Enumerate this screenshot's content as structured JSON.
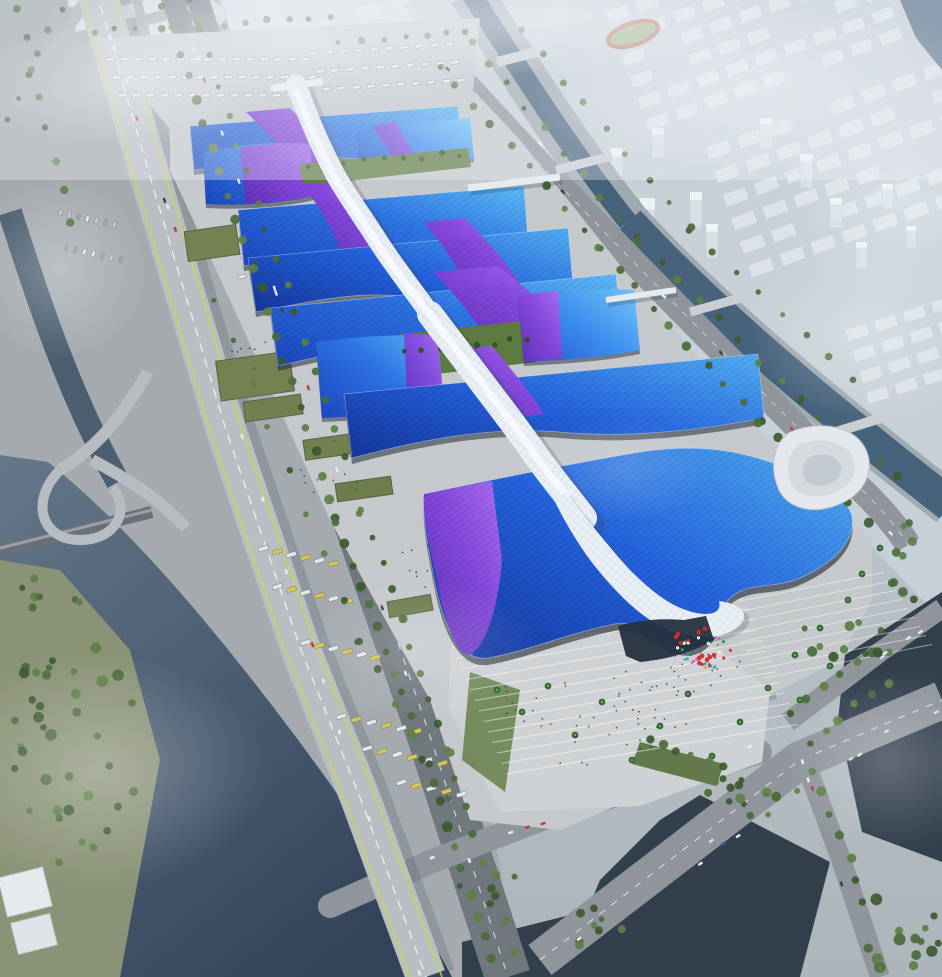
{
  "meta": {
    "title": "Aerial rendering of a riverside exhibition and convention center",
    "description": "Bird's-eye architectural rendering: rows of wavy blue exhibition-hall roofs with purple ribbon graphics, crossed by a white serpentine central concourse, surrounded by boulevards, canals, ponds, parking aprons and a foggy city skyline."
  },
  "palette": {
    "bgTop": "#d6dfe5",
    "bgBottom": "#adb5bb",
    "westLand": "#a4aaae",
    "eastLand": "#c7d0d6",
    "cityBlock": "#e0e6ea",
    "cityStroke": "#c4cdd3",
    "towerBody": "#d9e0e6",
    "towerTop": "#eef2f6",
    "waterCanal": "#47637c",
    "waterWest": "#4c5f70",
    "waterSWTop": "#64788a",
    "waterSWBot": "#33445a",
    "pond": "#323f4d",
    "bank": "#9fa9b0",
    "roadHwy": "#b9bec3",
    "roadMain": "#70777d",
    "roadMid": "#8f959b",
    "laneWhite": "#eef1f3",
    "laneYellow": "#c9d64f",
    "apron": "#c5c9cb",
    "plaza": "#cfd2d4",
    "garden": "#5d7a40",
    "grassDark": "#55703c",
    "treeDark": "#3c5a30",
    "tree": "#4a6b3a",
    "treeLight": "#5c7f46",
    "palm": "#2f6b38",
    "roofDeep": "#1c49c0",
    "roofBlue": "#2e74e4",
    "roofLight": "#4fa8f0",
    "purpleDeep": "#5f2fb4",
    "purple": "#8448dc",
    "purpleLight": "#a86ef0",
    "spine": "#e9eff5",
    "spineShadow": "#36444f",
    "glass": "#253140",
    "sideDark": "#232d39",
    "swirl": "#e4e8ec",
    "lantern": "#d82828",
    "trackRed": "#b85040",
    "infield": "#8aa060"
  },
  "scene": {
    "seed": 7,
    "city_grids": [
      {
        "x": 598,
        "y": -10,
        "rot": -20,
        "cols": 9,
        "rows": 7,
        "w": 22,
        "h": 12,
        "dx": 31,
        "dy": 23,
        "op": 0.9
      },
      {
        "x": 705,
        "y": 148,
        "rot": -20,
        "cols": 8,
        "rows": 6,
        "w": 24,
        "h": 13,
        "dx": 33,
        "dy": 25,
        "op": 0.85
      },
      {
        "x": 845,
        "y": 330,
        "rot": -18,
        "cols": 4,
        "rows": 4,
        "w": 22,
        "h": 12,
        "dx": 30,
        "dy": 22,
        "op": 0.8
      },
      {
        "x": 66,
        "y": -6,
        "rot": -14,
        "cols": 6,
        "rows": 3,
        "w": 26,
        "h": 14,
        "dx": 36,
        "dy": 25,
        "op": 0.85
      },
      {
        "x": 348,
        "y": -12,
        "rot": -18,
        "cols": 5,
        "rows": 2,
        "w": 24,
        "h": 12,
        "dx": 32,
        "dy": 22,
        "op": 0.8
      }
    ],
    "towers": [
      [
        530,
        178,
        12,
        36
      ],
      [
        560,
        208,
        16,
        55
      ],
      [
        585,
        233,
        14,
        46
      ],
      [
        610,
        188,
        13,
        40
      ],
      [
        640,
        248,
        15,
        50
      ],
      [
        652,
        158,
        12,
        30
      ],
      [
        662,
        283,
        13,
        38
      ],
      [
        690,
        228,
        12,
        36
      ],
      [
        706,
        258,
        12,
        34
      ],
      [
        760,
        148,
        12,
        30
      ],
      [
        800,
        188,
        13,
        34
      ],
      [
        830,
        228,
        12,
        30
      ],
      [
        856,
        268,
        11,
        26
      ],
      [
        882,
        208,
        11,
        24
      ],
      [
        906,
        248,
        10,
        22
      ]
    ],
    "tree_lines": [
      {
        "x1": 162,
        "y1": 6,
        "x2": 252,
        "y2": 266,
        "n": 12,
        "r": 4
      },
      {
        "x1": 252,
        "y1": 266,
        "x2": 338,
        "y2": 520,
        "n": 12,
        "r": 4
      },
      {
        "x1": 338,
        "y1": 520,
        "x2": 424,
        "y2": 758,
        "n": 12,
        "r": 4.4
      },
      {
        "x1": 424,
        "y1": 758,
        "x2": 492,
        "y2": 960,
        "n": 10,
        "r": 4.6
      },
      {
        "x1": 188,
        "y1": 0,
        "x2": 276,
        "y2": 258,
        "n": 10,
        "r": 3.2
      },
      {
        "x1": 276,
        "y1": 258,
        "x2": 362,
        "y2": 512,
        "n": 10,
        "r": 3.4
      },
      {
        "x1": 362,
        "y1": 512,
        "x2": 448,
        "y2": 752,
        "n": 10,
        "r": 3.6
      },
      {
        "x1": 448,
        "y1": 752,
        "x2": 512,
        "y2": 950,
        "n": 8,
        "r": 3.8
      },
      {
        "x1": 18,
        "y1": 10,
        "x2": 70,
        "y2": 220,
        "n": 8,
        "r": 3.4
      },
      {
        "x1": 60,
        "y1": 8,
        "x2": 6,
        "y2": 118,
        "n": 6,
        "r": 3
      },
      {
        "x1": 438,
        "y1": 64,
        "x2": 600,
        "y2": 250,
        "n": 10,
        "r": 3.6
      },
      {
        "x1": 600,
        "y1": 250,
        "x2": 760,
        "y2": 420,
        "n": 10,
        "r": 3.8
      },
      {
        "x1": 760,
        "y1": 420,
        "x2": 868,
        "y2": 520,
        "n": 7,
        "r": 4
      },
      {
        "x1": 470,
        "y1": 40,
        "x2": 640,
        "y2": 240,
        "n": 10,
        "r": 3.2
      },
      {
        "x1": 640,
        "y1": 240,
        "x2": 800,
        "y2": 400,
        "n": 9,
        "r": 3.4
      },
      {
        "x1": 800,
        "y1": 400,
        "x2": 898,
        "y2": 478,
        "n": 6,
        "r": 3.6
      },
      {
        "x1": 520,
        "y1": 30,
        "x2": 690,
        "y2": 230,
        "n": 9,
        "r": 3
      },
      {
        "x1": 690,
        "y1": 230,
        "x2": 850,
        "y2": 380,
        "n": 8,
        "r": 3.2
      },
      {
        "x1": 95,
        "y1": 32,
        "x2": 330,
        "y2": 18,
        "n": 12,
        "r": 3
      },
      {
        "x1": 340,
        "y1": 42,
        "x2": 468,
        "y2": 32,
        "n": 7,
        "r": 3
      },
      {
        "x1": 215,
        "y1": 300,
        "x2": 360,
        "y2": 640,
        "n": 9,
        "r": 3.2
      },
      {
        "x1": 360,
        "y1": 640,
        "x2": 448,
        "y2": 796,
        "n": 6,
        "r": 3.4
      },
      {
        "x1": 792,
        "y1": 712,
        "x2": 872,
        "y2": 652,
        "n": 6,
        "r": 4
      },
      {
        "x1": 808,
        "y1": 742,
        "x2": 888,
        "y2": 682,
        "n": 6,
        "r": 4
      },
      {
        "x1": 812,
        "y1": 772,
        "x2": 858,
        "y2": 880,
        "n": 6,
        "r": 4.2
      },
      {
        "x1": 648,
        "y1": 742,
        "x2": 722,
        "y2": 768,
        "n": 6,
        "r": 3.8
      }
    ],
    "tree_clusters": [
      {
        "cx": 75,
        "cy": 760,
        "rx": 70,
        "ry": 120,
        "n": 32,
        "r": 4.6
      },
      {
        "cx": 40,
        "cy": 620,
        "rx": 45,
        "ry": 60,
        "n": 12,
        "r": 4.2
      },
      {
        "cx": 850,
        "cy": 640,
        "rx": 55,
        "ry": 26,
        "n": 12,
        "r": 4
      },
      {
        "cx": 740,
        "cy": 800,
        "rx": 70,
        "ry": 22,
        "n": 14,
        "r": 4
      },
      {
        "cx": 900,
        "cy": 930,
        "rx": 50,
        "ry": 50,
        "n": 16,
        "r": 4.6
      },
      {
        "cx": 600,
        "cy": 930,
        "rx": 40,
        "ry": 28,
        "n": 8,
        "r": 4
      },
      {
        "cx": 488,
        "cy": 884,
        "rx": 30,
        "ry": 24,
        "n": 6,
        "r": 3.8
      },
      {
        "cx": 912,
        "cy": 560,
        "rx": 26,
        "ry": 46,
        "n": 9,
        "r": 3.8
      }
    ],
    "garden_trees": [
      {
        "x1": 306,
        "y1": 168,
        "x2": 462,
        "y2": 153,
        "n": 9,
        "r": 2.6
      },
      {
        "x1": 404,
        "y1": 352,
        "x2": 528,
        "y2": 338,
        "n": 8,
        "r": 2.9
      }
    ],
    "palms": [
      [
        497,
        690
      ],
      [
        522,
        712
      ],
      [
        548,
        686
      ],
      [
        575,
        735
      ],
      [
        602,
        702
      ],
      [
        632,
        760
      ],
      [
        660,
        726
      ],
      [
        688,
        694
      ],
      [
        712,
        756
      ],
      [
        740,
        722
      ],
      [
        768,
        688
      ],
      [
        795,
        655
      ],
      [
        820,
        628
      ],
      [
        848,
        600
      ],
      [
        800,
        700
      ],
      [
        830,
        666
      ],
      [
        862,
        574
      ],
      [
        880,
        548
      ]
    ],
    "vehicle_rows": [
      {
        "x": 106,
        "y": 58,
        "n": 15,
        "dx": 14,
        "dy": 0,
        "len": 8,
        "w": 3.5,
        "rot": -8,
        "kind": "truck"
      },
      {
        "x": 112,
        "y": 76,
        "n": 15,
        "dx": 14,
        "dy": 0,
        "len": 8,
        "w": 3.5,
        "rot": -8,
        "kind": "truck"
      },
      {
        "x": 118,
        "y": 94,
        "n": 14,
        "dx": 14,
        "dy": 0,
        "len": 8,
        "w": 3.5,
        "rot": -8,
        "kind": "truck"
      },
      {
        "x": 310,
        "y": 52,
        "n": 10,
        "dx": 15,
        "dy": -1,
        "len": 8,
        "w": 3.5,
        "rot": -8,
        "kind": "truck"
      },
      {
        "x": 316,
        "y": 70,
        "n": 10,
        "dx": 15,
        "dy": -1,
        "len": 8,
        "w": 3.5,
        "rot": -8,
        "kind": "truck"
      },
      {
        "x": 322,
        "y": 88,
        "n": 10,
        "dx": 15,
        "dy": -1,
        "len": 8,
        "w": 3.5,
        "rot": -8,
        "kind": "truck"
      },
      {
        "x": 58,
        "y": 215,
        "n": 7,
        "dx": 9,
        "dy": 2,
        "len": 6,
        "w": 3,
        "rot": -70,
        "kind": "car"
      },
      {
        "x": 64,
        "y": 250,
        "n": 7,
        "dx": 9,
        "dy": 2,
        "len": 6,
        "w": 3,
        "rot": -70,
        "kind": "car"
      },
      {
        "x": 228,
        "y": 252,
        "n": 6,
        "dx": 12,
        "dy": 3,
        "len": 8,
        "w": 3.2,
        "rot": -14,
        "kind": "truck"
      },
      {
        "x": 238,
        "y": 276,
        "n": 6,
        "dx": 12,
        "dy": 3,
        "len": 8,
        "w": 3.2,
        "rot": -14,
        "kind": "truck"
      },
      {
        "x": 258,
        "y": 548,
        "n": 6,
        "dx": 14,
        "dy": 3,
        "len": 10,
        "w": 4,
        "rot": -16,
        "kind": "bus"
      },
      {
        "x": 272,
        "y": 586,
        "n": 6,
        "dx": 14,
        "dy": 3,
        "len": 10,
        "w": 4,
        "rot": -16,
        "kind": "bus"
      },
      {
        "x": 300,
        "y": 642,
        "n": 6,
        "dx": 14,
        "dy": 3,
        "len": 10,
        "w": 4,
        "rot": -16,
        "kind": "bus"
      },
      {
        "x": 336,
        "y": 716,
        "n": 6,
        "dx": 15,
        "dy": 3,
        "len": 10,
        "w": 4,
        "rot": -18,
        "kind": "bus"
      },
      {
        "x": 362,
        "y": 748,
        "n": 6,
        "dx": 15,
        "dy": 3,
        "len": 10,
        "w": 4,
        "rot": -18,
        "kind": "bus"
      },
      {
        "x": 396,
        "y": 782,
        "n": 5,
        "dx": 15,
        "dy": 3,
        "len": 10,
        "w": 4,
        "rot": -18,
        "kind": "bus"
      }
    ],
    "car_lanes": [
      {
        "x1": 100,
        "y1": 0,
        "x2": 420,
        "y2": 970,
        "n": 16
      },
      {
        "x1": 182,
        "y1": 10,
        "x2": 505,
        "y2": 965,
        "n": 14
      },
      {
        "x1": 445,
        "y1": 70,
        "x2": 900,
        "y2": 540,
        "n": 10
      },
      {
        "x1": 540,
        "y1": 955,
        "x2": 935,
        "y2": 705,
        "n": 9
      },
      {
        "x1": 760,
        "y1": 752,
        "x2": 430,
        "y2": 862,
        "n": 5
      },
      {
        "x1": 800,
        "y1": 748,
        "x2": 868,
        "y2": 960,
        "n": 4
      },
      {
        "x1": 788,
        "y1": 722,
        "x2": 935,
        "y2": 612,
        "n": 4
      }
    ],
    "step_fans": [
      {
        "x": 452,
        "y": 648,
        "n": 13,
        "dx": 4.5,
        "dy": 10.5,
        "len": 292,
        "slope": -0.17,
        "op": 0.5
      },
      {
        "x": 716,
        "y": 606,
        "n": 9,
        "dx": 6,
        "dy": 9,
        "len": 168,
        "slope": -0.2,
        "op": 0.45
      }
    ],
    "people_clusters": [
      {
        "cx": 660,
        "cy": 690,
        "rx": 60,
        "ry": 40,
        "n": 30
      },
      {
        "cx": 700,
        "cy": 660,
        "rx": 40,
        "ry": 20,
        "n": 20
      },
      {
        "cx": 600,
        "cy": 740,
        "rx": 70,
        "ry": 30,
        "n": 16
      },
      {
        "cx": 330,
        "cy": 470,
        "rx": 40,
        "ry": 30,
        "n": 12
      },
      {
        "cx": 262,
        "cy": 352,
        "rx": 30,
        "ry": 22,
        "n": 10
      },
      {
        "cx": 420,
        "cy": 564,
        "rx": 30,
        "ry": 24,
        "n": 10
      },
      {
        "cx": 540,
        "cy": 700,
        "rx": 40,
        "ry": 26,
        "n": 12
      }
    ],
    "flags": {
      "cx": 703,
      "cy": 652,
      "rx": 30,
      "ry": 17,
      "n": 26,
      "colors": [
        "#e03030",
        "#f2a824",
        "#2e9e4f",
        "#2f62d8",
        "#e061c0",
        "#22b8c8",
        "#f2f2f2"
      ]
    },
    "lanterns": {
      "cx": 697,
      "cy": 646,
      "rx": 27,
      "ry": 20,
      "n": 11,
      "r": 2.3
    },
    "fog_blobs": [
      {
        "x": 300,
        "y": 36,
        "rx": 270,
        "ry": 72,
        "op": 0.6
      },
      {
        "x": 560,
        "y": 16,
        "rx": 220,
        "ry": 60,
        "op": 0.55
      },
      {
        "x": 760,
        "y": 90,
        "rx": 230,
        "ry": 95,
        "op": 0.5
      },
      {
        "x": 905,
        "y": 200,
        "rx": 130,
        "ry": 110,
        "op": 0.42
      },
      {
        "x": 870,
        "y": 330,
        "rx": 120,
        "ry": 90,
        "op": 0.35
      },
      {
        "x": 120,
        "y": 84,
        "rx": 150,
        "ry": 64,
        "op": 0.45
      },
      {
        "x": 60,
        "y": 270,
        "rx": 90,
        "ry": 90,
        "op": 0.3
      },
      {
        "x": 100,
        "y": 770,
        "rx": 170,
        "ry": 115,
        "op": 0.3
      },
      {
        "x": 420,
        "y": 650,
        "rx": 120,
        "ry": 70,
        "op": 0.2
      },
      {
        "x": 620,
        "y": 470,
        "rx": 90,
        "ry": 55,
        "op": 0.16
      },
      {
        "x": 890,
        "y": 760,
        "rx": 110,
        "ry": 90,
        "op": 0.25
      }
    ]
  }
}
